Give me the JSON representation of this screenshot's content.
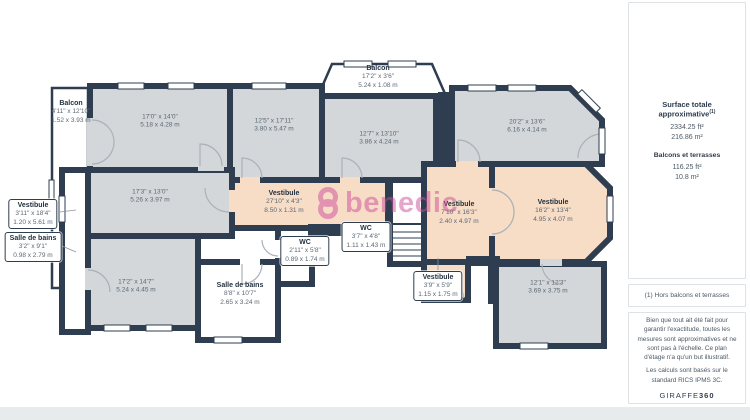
{
  "plan": {
    "watermark": {
      "text": "benedic",
      "color": "#cf4d9a"
    },
    "colors": {
      "wall": "#2e3d4f",
      "room_gray": "#d3d7d9",
      "room_peach": "#f7dcc6",
      "room_white": "#ffffff"
    },
    "labels": [
      {
        "name": "Balcon",
        "ft": "4'11\" x 12'10\"",
        "m": "1.52 x 3.93 m"
      },
      {
        "name": "",
        "ft": "17'0\" x 14'0\"",
        "m": "5.18 x 4.28 m"
      },
      {
        "name": "",
        "ft": "12'5\" x 17'11\"",
        "m": "3.80 x 5.47 m"
      },
      {
        "name": "Balcon",
        "ft": "17'2\" x 3'6\"",
        "m": "5.24 x 1.08 m"
      },
      {
        "name": "",
        "ft": "12'7\" x 13'10\"",
        "m": "3.86 x 4.24 m"
      },
      {
        "name": "",
        "ft": "20'2\" x 13'6\"",
        "m": "6.16 x 4.14 m"
      },
      {
        "name": "",
        "ft": "17'3\" x 13'0\"",
        "m": "5.26 x 3.97 m"
      },
      {
        "name": "Vestibule",
        "ft": "3'11\" x 18'4\"",
        "m": "1.20 x 5.61 m"
      },
      {
        "name": "Salle de bains",
        "ft": "3'2\" x 9'1\"",
        "m": "0.98 x 2.79 m"
      },
      {
        "name": "Vestibule",
        "ft": "27'10\" x 4'3\"",
        "m": "8.50 x 1.31 m"
      },
      {
        "name": "WC",
        "ft": "2'11\" x 5'8\"",
        "m": "0.89 x 1.74 m"
      },
      {
        "name": "WC",
        "ft": "3'7\" x 4'8\"",
        "m": "1.11 x 1.43 m"
      },
      {
        "name": "",
        "ft": "17'2\" x 14'7\"",
        "m": "5.24 x 4.45 m"
      },
      {
        "name": "Salle de bains",
        "ft": "8'8\" x 10'7\"",
        "m": "2.65 x 3.24 m"
      },
      {
        "name": "Vestibule",
        "ft": "7'10\" x 16'3\"",
        "m": "2.40 x 4.97 m"
      },
      {
        "name": "Vestibule",
        "ft": "16'2\" x 13'4\"",
        "m": "4.95 x 4.07 m"
      },
      {
        "name": "Vestibule",
        "ft": "3'9\" x 5'9\"",
        "m": "1.15 x 1.75 m"
      },
      {
        "name": "",
        "ft": "12'1\" x 12'3\"",
        "m": "3.69 x 3.75 m"
      }
    ]
  },
  "sidebar": {
    "total": {
      "title": "Surface totale approximative",
      "sup": "(1)",
      "ft": "2334.25 ft²",
      "m": "216.86 m²"
    },
    "balconies": {
      "title": "Balcons et terrasses",
      "ft": "116.25 ft²",
      "m": "10.8 m²"
    },
    "note": "(1) Hors balcons et terrasses",
    "disclaimer1": "Bien que tout ait été fait pour garantir l'exactitude, toutes les mesures sont approximatives et ne sont pas à l'échelle. Ce plan d'étage n'a qu'un but illustratif.",
    "disclaimer2": "Les calculs sont basés sur le standard RICS IPMS 3C.",
    "brand": "GIRAFFE",
    "brand_bold": "360"
  }
}
